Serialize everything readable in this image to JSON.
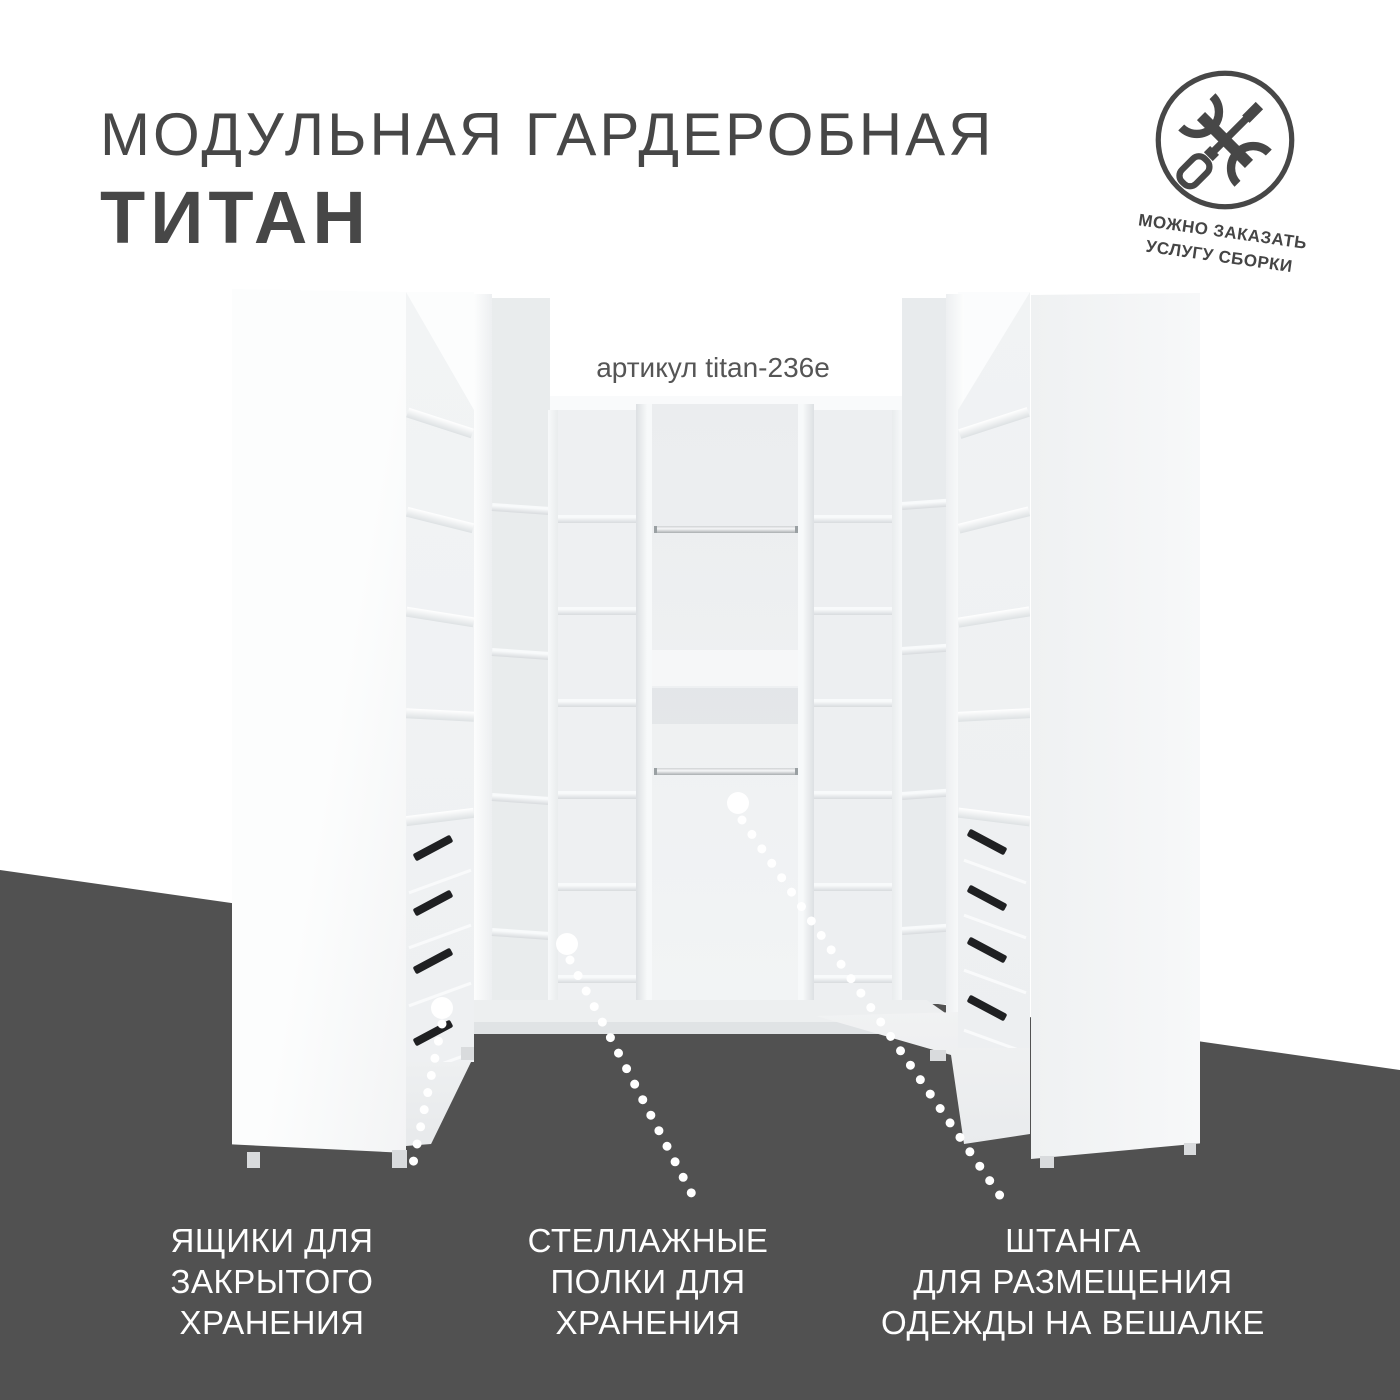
{
  "title": {
    "line1": "МОДУЛЬНАЯ ГАРДЕРОБНАЯ",
    "line2": "ТИТАН"
  },
  "assembly_badge": {
    "icon": "wrench-screwdriver-icon",
    "line1": "МОЖНО ЗАКАЗАТЬ",
    "line2": "УСЛУГУ СБОРКИ"
  },
  "product": {
    "sku_label": "артикул titan-236e"
  },
  "callouts": [
    {
      "id": "drawers",
      "lines": [
        "ЯЩИКИ ДЛЯ",
        "ЗАКРЫТОГО",
        "ХРАНЕНИЯ"
      ]
    },
    {
      "id": "shelves",
      "lines": [
        "СТЕЛЛАЖНЫЕ",
        "ПОЛКИ ДЛЯ",
        "ХРАНЕНИЯ"
      ]
    },
    {
      "id": "rod",
      "lines": [
        "ШТАНГА",
        "ДЛЯ РАЗМЕЩЕНИЯ",
        "ОДЕЖДЫ НА ВЕШАЛКЕ"
      ]
    }
  ],
  "colors": {
    "text_dark": "#474747",
    "background_dark": "#515151",
    "label_text": "#ffffff",
    "marker": "#ffffff"
  }
}
